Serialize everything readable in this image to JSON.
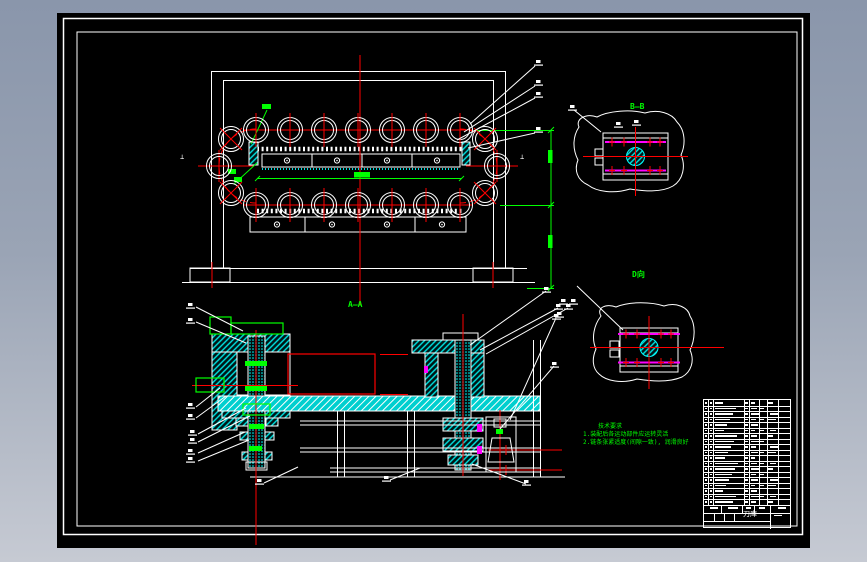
{
  "drawing": {
    "section_label": "A—A",
    "detail_b_label": "B—B",
    "detail_d_label": "D向",
    "datum_left": "⊥",
    "datum_right": "⊥",
    "notes": {
      "title": "技术要求",
      "line1": "1.装配后各运动部件应运转灵活",
      "line2": "2.链条张紧适度(间隙一致), 润滑良好"
    },
    "title_block": {
      "product": "刀库"
    },
    "colors": {
      "background_top": "#8A96AB",
      "background_bottom": "#C6CAD3",
      "canvas": "#000000",
      "line": "#FFFFFF",
      "centerline": "#FF0000",
      "dimension": "#00FF00",
      "hatch": "#00FFFF",
      "accent": "#FF00FF"
    }
  },
  "bom": {
    "rows": 19
  }
}
